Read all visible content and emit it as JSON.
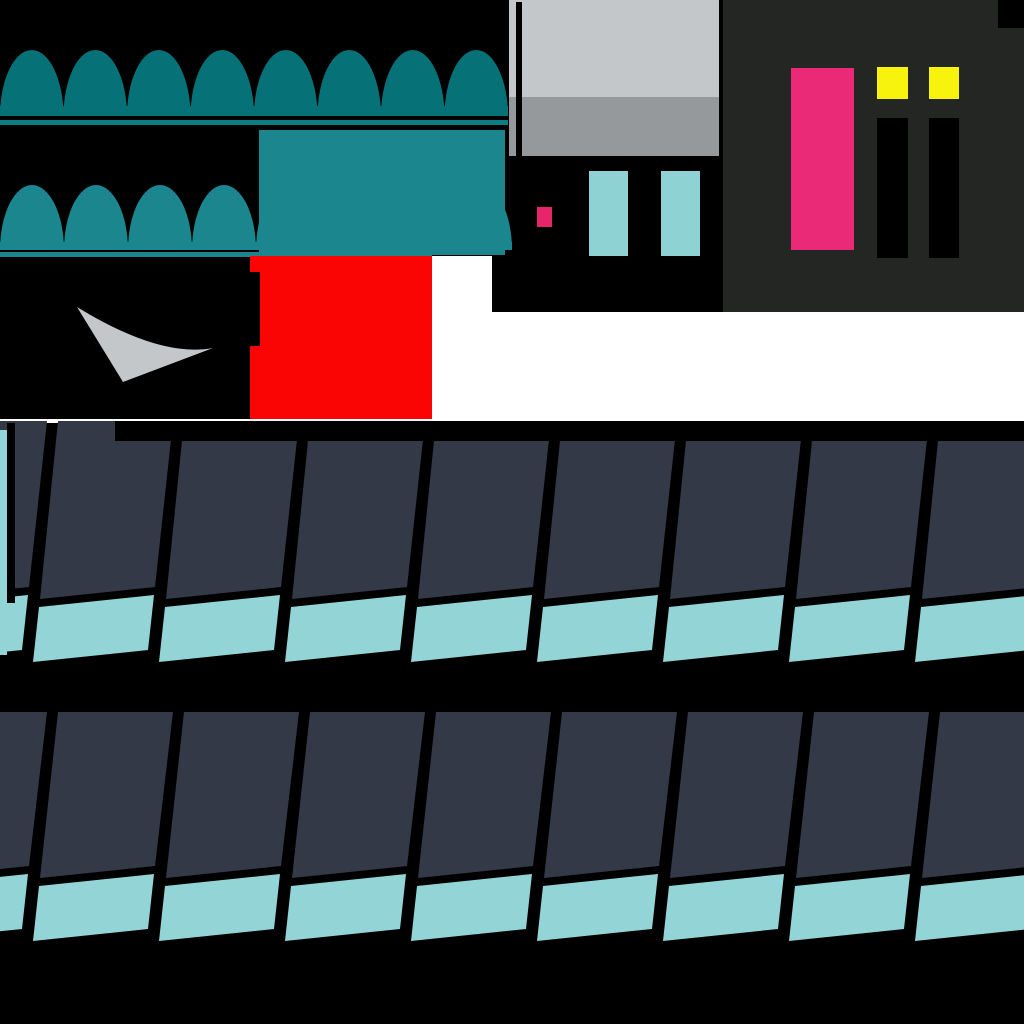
{
  "meta": {
    "kind": "sprite-sheet-texture-atlas",
    "canvas": {
      "width": 1024,
      "height": 1024
    }
  },
  "palette": {
    "white": "#ffffff",
    "black": "#000000",
    "awning_dark_teal": "#067177",
    "awning_light_teal": "#1b868d",
    "underline_teal": "#0d7d84",
    "red": "#fa0404",
    "swoosh_gray": "#c3c7c9",
    "wall_light_gray": "#c3c7ca",
    "wall_medium_gray": "#95999b",
    "window_cyan": "#8ed2d4",
    "small_light_pink": "#e72569",
    "panel_charcoal": "#232623",
    "door_pink": "#eb2a77",
    "lamp_yellow": "#f7f30d",
    "shingle_dark_slate": "#333946",
    "shingle_cyan": "#93d4d6"
  },
  "paint_order": [
    {
      "name": "background",
      "type": "rect",
      "x": 0,
      "y": 0,
      "w": 1024,
      "h": 1024,
      "color": "#ffffff"
    },
    {
      "name": "top-left-black-backdrop",
      "type": "rect",
      "x": 0,
      "y": 0,
      "w": 512,
      "h": 256,
      "color": "#000000"
    },
    {
      "name": "swoosh-black-backdrop",
      "type": "rect",
      "x": 0,
      "y": 256,
      "w": 250,
      "h": 163,
      "color": "#000000"
    },
    {
      "name": "storefront-facade-dark",
      "type": "rect",
      "x": 492,
      "y": 156,
      "w": 231,
      "h": 156,
      "color": "#000000"
    },
    {
      "name": "storefront-wall-upper",
      "type": "rect",
      "x": 509,
      "y": 0,
      "w": 210,
      "h": 97,
      "color": "#c3c7ca"
    },
    {
      "name": "storefront-wall-lower",
      "type": "rect",
      "x": 509,
      "y": 97,
      "w": 210,
      "h": 59,
      "color": "#95999b"
    },
    {
      "name": "storefront-wall-seam",
      "type": "rect",
      "x": 516,
      "y": 2,
      "w": 6,
      "h": 154,
      "color": "#000000"
    },
    {
      "name": "storefront-wall-right-gap",
      "type": "rect",
      "x": 719,
      "y": 0,
      "w": 4,
      "h": 156,
      "color": "#000000"
    },
    {
      "name": "facade-window-left",
      "type": "rect",
      "x": 589,
      "y": 171,
      "w": 39,
      "h": 85,
      "color": "#8ed2d4"
    },
    {
      "name": "facade-window-right",
      "type": "rect",
      "x": 661,
      "y": 171,
      "w": 39,
      "h": 85,
      "color": "#8ed2d4"
    },
    {
      "name": "facade-small-pink-light",
      "type": "rect",
      "x": 537,
      "y": 207,
      "w": 15,
      "h": 20,
      "color": "#e72569"
    },
    {
      "name": "door-panel",
      "type": "rect",
      "x": 723,
      "y": 0,
      "w": 301,
      "h": 312,
      "color": "#232623"
    },
    {
      "name": "door-panel-corner-notch",
      "type": "rect",
      "x": 998,
      "y": 0,
      "w": 26,
      "h": 28,
      "color": "#000000"
    },
    {
      "name": "door-pink-slab",
      "type": "rect",
      "x": 791,
      "y": 68,
      "w": 63,
      "h": 182,
      "color": "#eb2a77"
    },
    {
      "name": "door-lamp-left",
      "type": "rect",
      "x": 877,
      "y": 67,
      "w": 31,
      "h": 32,
      "color": "#f7f30d"
    },
    {
      "name": "door-lamp-right",
      "type": "rect",
      "x": 929,
      "y": 67,
      "w": 30,
      "h": 32,
      "color": "#f7f30d"
    },
    {
      "name": "door-slit-left",
      "type": "rect",
      "x": 877,
      "y": 118,
      "w": 31,
      "h": 140,
      "color": "#000000"
    },
    {
      "name": "door-slit-right",
      "type": "rect",
      "x": 929,
      "y": 118,
      "w": 30,
      "h": 140,
      "color": "#000000"
    },
    {
      "name": "awning-large",
      "type": "dome_row",
      "x": 0,
      "base_y": 116,
      "bump_width": 63.5,
      "count": 8,
      "dome_height": 66,
      "base_height": 10,
      "color": "#067177"
    },
    {
      "name": "awning-large-underline",
      "type": "rect",
      "x": 0,
      "y": 120,
      "w": 508,
      "h": 5,
      "color": "#0d7d84"
    },
    {
      "name": "awning-small",
      "type": "dome_row",
      "x": 0,
      "base_y": 250,
      "bump_width": 64,
      "count": 8,
      "dome_height": 65,
      "base_height": 8,
      "color": "#1b868d"
    },
    {
      "name": "awning-small-underline",
      "type": "rect",
      "x": 0,
      "y": 252,
      "w": 432,
      "h": 5,
      "color": "#1b868d"
    },
    {
      "name": "teal-canopy",
      "type": "rect",
      "x": 259,
      "y": 130,
      "w": 246,
      "h": 125,
      "color": "#1b868d"
    },
    {
      "name": "red-block",
      "type": "rect",
      "x": 250,
      "y": 256,
      "w": 182,
      "h": 163,
      "color": "#fa0404"
    },
    {
      "name": "red-block-notch",
      "type": "rect",
      "x": 249,
      "y": 272,
      "w": 11,
      "h": 74,
      "color": "#000000"
    },
    {
      "name": "gray-swoosh",
      "type": "path",
      "d": "M 77 307 Q 160 358 213 348 L 123 382 Z",
      "color": "#c3c7c9"
    },
    {
      "name": "shingle-field-backdrop",
      "type": "rect",
      "x": 0,
      "y": 423,
      "w": 1024,
      "h": 601,
      "color": "#000000"
    },
    {
      "name": "shingle-band-top",
      "type": "shingle_band",
      "y": 421,
      "dark_h_left": 178,
      "dark_h_right": 166,
      "gap": 8,
      "cyan_h": 55,
      "shear_dx": -18,
      "cyan_shear_dx": -6
    },
    {
      "name": "shingle-band-bottom",
      "type": "shingle_band",
      "y": 712,
      "dark_h_left": 166,
      "dark_h_right": 154,
      "gap": 8,
      "cyan_h": 55,
      "shear_dx": -18,
      "cyan_shear_dx": -6
    },
    {
      "name": "left-edge-cyan-trim",
      "type": "rect",
      "x": 0,
      "y": 430,
      "w": 7,
      "h": 225,
      "color": "#93d4d6"
    },
    {
      "name": "left-edge-black-trim",
      "type": "rect",
      "x": 7,
      "y": 423,
      "w": 8,
      "h": 180,
      "color": "#000000"
    },
    {
      "name": "shingle-top-black-bar",
      "type": "rect",
      "x": 115,
      "y": 421,
      "w": 909,
      "h": 20,
      "color": "#000000"
    }
  ],
  "shingle_grid": {
    "pitch": 126,
    "divider_x0": 47,
    "tile_top_width": 115,
    "tile_count": 9,
    "dark_color": "#333946",
    "cyan_color": "#93d4d6"
  }
}
